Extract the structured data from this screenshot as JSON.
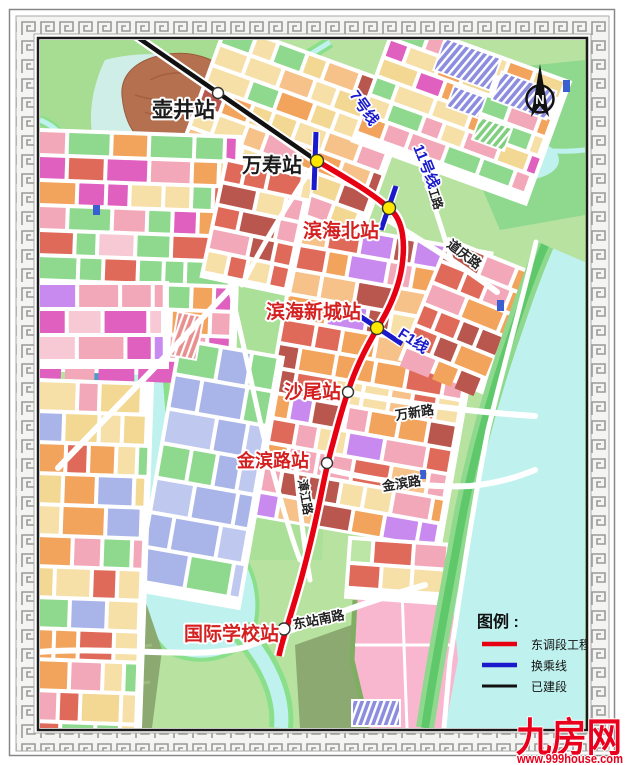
{
  "stations": [
    {
      "name": "壶井站",
      "label_color": "#1a1a1a",
      "marker_fill": "#ffffff",
      "status": "built"
    },
    {
      "name": "万寿站",
      "label_color": "#1a1a1a",
      "marker_fill": "#ffe800",
      "status": "interchange"
    },
    {
      "name": "滨海北站",
      "label_color": "#d42020",
      "marker_fill": "#ffe800",
      "status": "interchange"
    },
    {
      "name": "滨海新城站",
      "label_color": "#d42020",
      "marker_fill": "#ffe800",
      "status": "interchange"
    },
    {
      "name": "沙尾站",
      "label_color": "#d42020",
      "marker_fill": "#ffffff",
      "status": "planned"
    },
    {
      "name": "金滨路站",
      "label_color": "#d42020",
      "marker_fill": "#ffffff",
      "status": "planned"
    },
    {
      "name": "国际学校站",
      "label_color": "#d42020",
      "marker_fill": "#ffffff",
      "status": "planned"
    }
  ],
  "transfer_lines": [
    {
      "label": "7号线"
    },
    {
      "label": "11号线"
    },
    {
      "label": "F1线"
    }
  ],
  "line_colors": {
    "east_extension": "#e60012",
    "transfer": "#1a1acc",
    "built": "#111111"
  },
  "roads": [
    {
      "label": "道庆路"
    },
    {
      "label": "滨江路"
    },
    {
      "label": "万新路"
    },
    {
      "label": "金滨路"
    },
    {
      "label": "漳江路"
    },
    {
      "label": "东站南路"
    }
  ],
  "legend": {
    "title": "图例 :",
    "items": [
      {
        "label": "东调段工程",
        "color": "#e60012"
      },
      {
        "label": "换乘线",
        "color": "#1a1acc"
      },
      {
        "label": "已建段",
        "color": "#111111"
      }
    ]
  },
  "compass": {
    "label": "N"
  },
  "watermark": {
    "brand": "九房网",
    "url": "www.999house.com",
    "color": "#e8001c"
  }
}
